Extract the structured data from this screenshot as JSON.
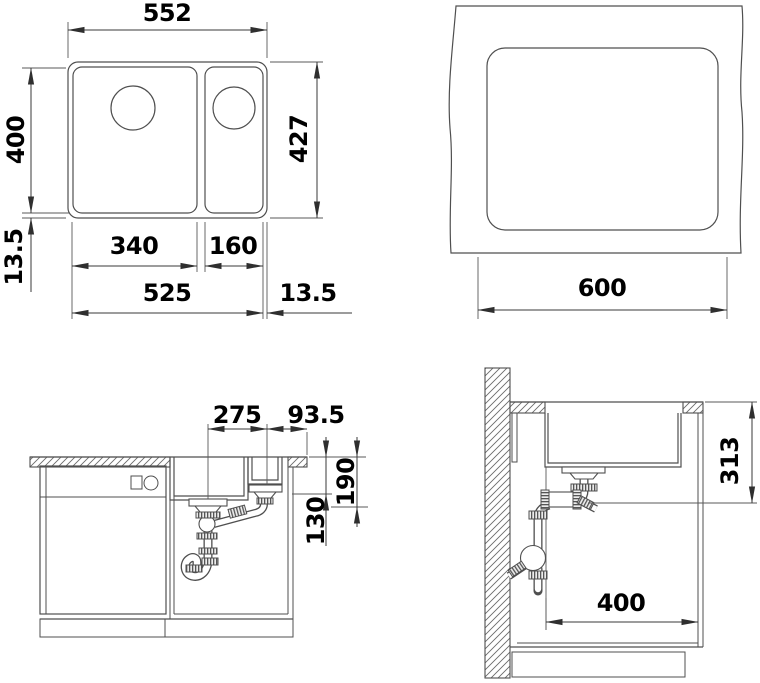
{
  "colors": {
    "line": "#4f4f4f",
    "text": "#000000",
    "background": "#ffffff"
  },
  "views": {
    "top_view": {
      "label": "sink top view",
      "dims": {
        "overall_width": "552",
        "bowl_depth": "400",
        "overall_depth": "427",
        "rim_offset_left": "13.5",
        "main_bowl_width": "340",
        "side_bowl_width": "160",
        "inner_width": "525",
        "rim_offset_right": "13.5"
      }
    },
    "cutout_view": {
      "label": "worktop cutout view",
      "dims": {
        "cutout_width": "600"
      }
    },
    "front_view": {
      "label": "front section view",
      "dims": {
        "drain_spacing": "275",
        "drain_to_edge": "93.5",
        "main_bowl_depth": "190",
        "side_bowl_depth": "130"
      }
    },
    "side_view": {
      "label": "side section view",
      "dims": {
        "install_depth": "313",
        "min_cabinet_depth": "400"
      }
    }
  }
}
